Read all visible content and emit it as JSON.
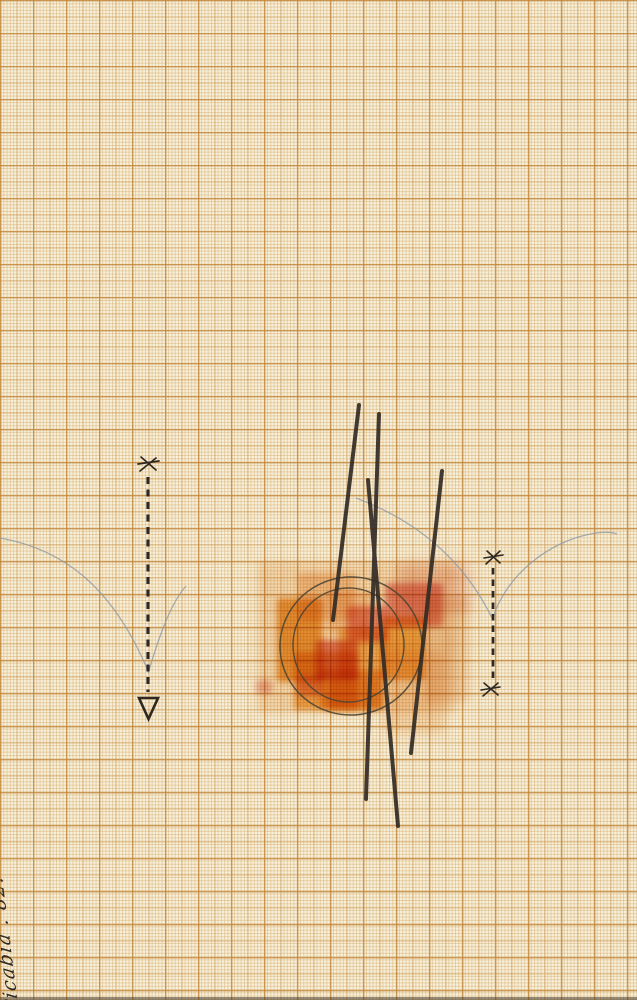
{
  "artwork": {
    "signature": "Picabia . 82."
  },
  "palette": {
    "paper": "#f7f0da",
    "grid_fine": "rgba(214,173,113,0.50)",
    "grid_medium": "rgba(205,152,79,0.55)",
    "grid_heavy": "rgba(191,132,56,0.62)",
    "ink": "#2e2821",
    "charcoal": "#332c25",
    "pencil": "#8e9aa8",
    "circle_pen": "#4e4633"
  },
  "washes": [
    {
      "name": "wash-base",
      "x": 257,
      "y": 562,
      "w": 200,
      "h": 150,
      "c": "#f2bd7e",
      "o": 0.4,
      "b": 4
    },
    {
      "name": "wash-right",
      "x": 425,
      "y": 597,
      "w": 45,
      "h": 105,
      "c": "#eec08f",
      "o": 0.45,
      "b": 4
    },
    {
      "name": "wash-bottom-right",
      "x": 385,
      "y": 650,
      "w": 60,
      "h": 84,
      "c": "#f0b26a",
      "o": 0.35,
      "b": 5
    },
    {
      "name": "blush-top-right",
      "x": 398,
      "y": 563,
      "w": 72,
      "h": 50,
      "c": "#e89b84",
      "o": 0.4,
      "b": 6
    },
    {
      "name": "peach-top-left",
      "x": 298,
      "y": 573,
      "w": 58,
      "h": 48,
      "c": "#f5c28b",
      "o": 0.65,
      "b": 3
    },
    {
      "name": "pale-top-center",
      "x": 328,
      "y": 591,
      "w": 44,
      "h": 44,
      "c": "#f7d0a4",
      "o": 0.7,
      "b": 3
    },
    {
      "name": "deep-orange-left",
      "x": 277,
      "y": 598,
      "w": 46,
      "h": 84,
      "c": "#ea9011",
      "o": 0.78,
      "b": 3
    },
    {
      "name": "orange-bottom-left",
      "x": 294,
      "y": 652,
      "w": 64,
      "h": 58,
      "c": "#f09d1f",
      "o": 0.7,
      "b": 3
    },
    {
      "name": "yellow-center",
      "x": 338,
      "y": 628,
      "w": 50,
      "h": 50,
      "c": "#f3ae3a",
      "o": 0.75,
      "b": 3
    },
    {
      "name": "golden-right",
      "x": 382,
      "y": 616,
      "w": 44,
      "h": 64,
      "c": "#f2a82e",
      "o": 0.8,
      "b": 3
    },
    {
      "name": "orange-bottom-center",
      "x": 320,
      "y": 670,
      "w": 64,
      "h": 40,
      "c": "#efa028",
      "o": 0.7,
      "b": 3
    },
    {
      "name": "orange-bottom-deep",
      "x": 330,
      "y": 678,
      "w": 52,
      "h": 32,
      "c": "#ed9a1d",
      "o": 0.6,
      "b": 3
    },
    {
      "name": "red-top-right",
      "x": 385,
      "y": 583,
      "w": 58,
      "h": 44,
      "c": "#e26e5e",
      "o": 0.7,
      "b": 3
    },
    {
      "name": "red-center",
      "x": 347,
      "y": 606,
      "w": 40,
      "h": 36,
      "c": "#e87366",
      "o": 0.72,
      "b": 3
    },
    {
      "name": "red-center-left",
      "x": 316,
      "y": 640,
      "w": 42,
      "h": 40,
      "c": "#e26d59",
      "o": 0.8,
      "b": 3
    },
    {
      "name": "red-small-bottom-left",
      "x": 297,
      "y": 676,
      "w": 26,
      "h": 20,
      "c": "#e87b67",
      "o": 0.6,
      "b": 3
    },
    {
      "name": "red-tiny-left",
      "x": 256,
      "y": 680,
      "w": 16,
      "h": 14,
      "c": "#e58878",
      "o": 0.5,
      "b": 3
    }
  ]
}
